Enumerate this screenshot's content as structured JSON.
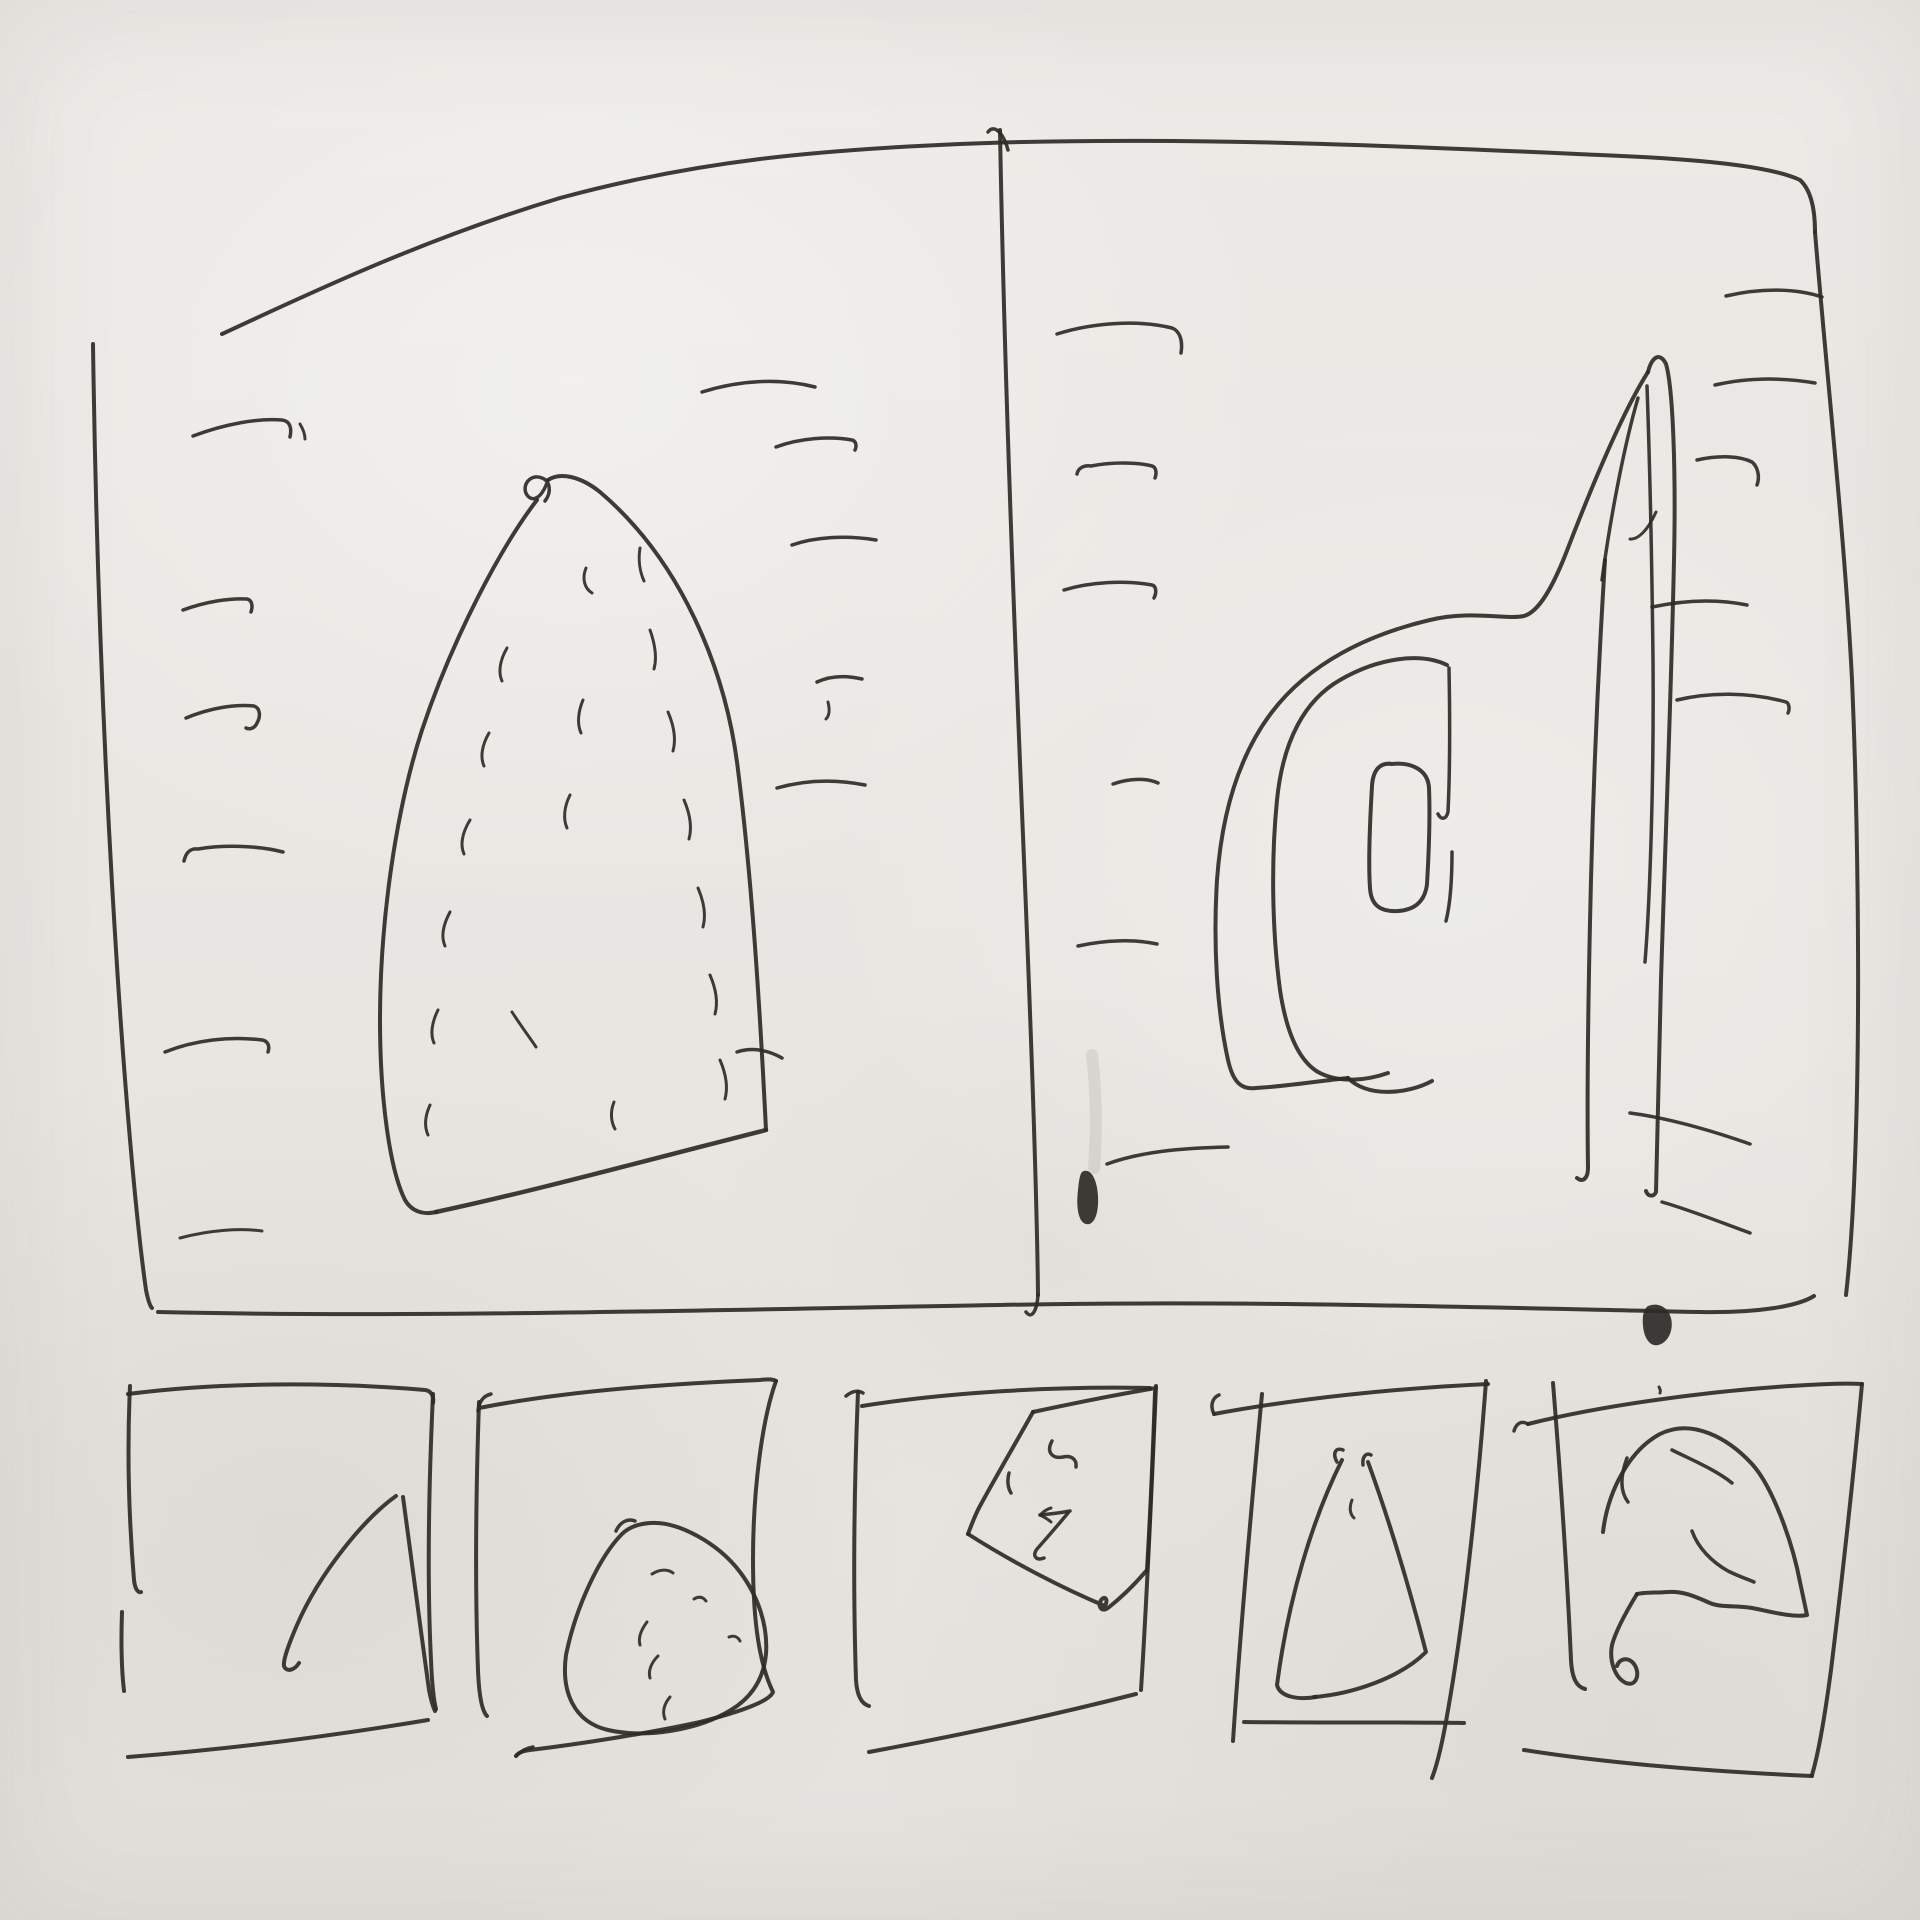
{
  "meta": {
    "title": "Hand-drawn ink wireframe sketch: two-panel viewer with filmstrip of five thumbnails",
    "canvas": {
      "width": 1920,
      "height": 1920
    }
  },
  "palette": {
    "paper": "#e9e7e2",
    "ink": "#2e2b27",
    "smudge": "#76726a"
  },
  "sketch": {
    "viewbox": "0 0 1920 1920",
    "default_width": 4,
    "strokes": [
      {
        "name": "main-frame-top-edge",
        "d": "M222,334 C300,298 420,240 560,198 C700,160 820,150 960,144 C1180,135 1420,147 1600,155 C1700,159 1770,166 1800,180 C1811,190 1815,210 1815,232",
        "w": 4
      },
      {
        "name": "main-frame-left-edge",
        "d": "M93,344 C96,560 104,760 116,950 C124,1080 136,1220 146,1290 C148,1300 150,1306 152,1308",
        "w": 4
      },
      {
        "name": "main-frame-bottom-edge",
        "d": "M158,1312 C420,1318 700,1310 1000,1305 C1250,1300 1500,1308 1700,1312 C1760,1313 1798,1306 1814,1296",
        "w": 4
      },
      {
        "name": "main-frame-right-edge",
        "d": "M1815,232 C1828,390 1845,540 1852,680 C1858,820 1860,1000 1856,1130 C1854,1200 1850,1260 1846,1295",
        "w": 4
      },
      {
        "name": "panel-divider-line",
        "d": "M1000,130 C1004,360 1014,620 1024,860 C1031,1030 1037,1200 1038,1295",
        "w": 4
      },
      {
        "name": "panel-divider-top-hook",
        "d": "M1008,150 C1003,132 994,124 988,132",
        "w": 3.5
      },
      {
        "name": "panel-divider-bottom-hook",
        "d": "M1038,1295 C1037,1310 1032,1320 1026,1312",
        "w": 3.5
      },
      {
        "name": "left-margin-tick-1",
        "d": "M193,436 C225,424 258,418 282,420 C290,421 292,428 290,437",
        "w": 3.5
      },
      {
        "name": "left-margin-tick-1-apostrophe",
        "d": "M300,424 C303,429 305,434 305,439",
        "w": 3
      },
      {
        "name": "left-margin-tick-2",
        "d": "M183,610 C205,602 228,598 247,599 C252,600 253,606 251,612",
        "w": 3.5
      },
      {
        "name": "left-margin-tick-3",
        "d": "M186,718 C210,708 235,704 254,706 C260,708 261,716 257,723 C255,728 250,730 246,728",
        "w": 3.5
      },
      {
        "name": "left-margin-tick-4",
        "d": "M184,861 C186,852 191,848 198,849 C222,845 256,845 283,852",
        "w": 3.5
      },
      {
        "name": "left-margin-tick-5",
        "d": "M165,1052 C195,1040 230,1036 262,1040 C268,1041 270,1046 268,1052",
        "w": 3.5
      },
      {
        "name": "left-margin-tick-6",
        "d": "M180,1238 C210,1230 240,1228 262,1231",
        "w": 3
      },
      {
        "name": "sail-shape-left-edge",
        "d": "M537,500 C500,548 452,640 422,730 C396,810 380,920 380,1020 C380,1100 390,1170 405,1200 C412,1212 424,1215 436,1212",
        "w": 4
      },
      {
        "name": "sail-shape-bottom-edge",
        "d": "M436,1212 C530,1192 640,1162 766,1130",
        "w": 4.5
      },
      {
        "name": "sail-shape-right-edge",
        "d": "M766,1130 C760,1010 752,880 738,770 C726,668 680,560 600,492 C580,476 560,472 548,480",
        "w": 4
      },
      {
        "name": "sail-apex-loop",
        "d": "M548,480 C542,498 533,503 527,495 C521,486 530,473 542,478 C550,481 552,492 545,501",
        "w": 3.5
      },
      {
        "name": "sail-hatch-1",
        "d": "M586,568 C582,578 584,588 592,593",
        "w": 3
      },
      {
        "name": "sail-hatch-2",
        "d": "M640,548 C638,560 640,572 644,581",
        "w": 3
      },
      {
        "name": "sail-hatch-3",
        "d": "M507,648 C500,660 498,672 502,681",
        "w": 3
      },
      {
        "name": "sail-hatch-4",
        "d": "M489,733 C482,745 480,757 484,766",
        "w": 3
      },
      {
        "name": "sail-hatch-5",
        "d": "M470,820 C462,833 460,845 464,854",
        "w": 3
      },
      {
        "name": "sail-hatch-6",
        "d": "M450,912 C443,925 441,937 445,946",
        "w": 3
      },
      {
        "name": "sail-hatch-7",
        "d": "M438,1010 C432,1022 430,1034 434,1043",
        "w": 3
      },
      {
        "name": "sail-hatch-8",
        "d": "M430,1105 C425,1116 424,1126 428,1135",
        "w": 3
      },
      {
        "name": "sail-hatch-9",
        "d": "M650,630 C655,644 657,658 654,669",
        "w": 3
      },
      {
        "name": "sail-hatch-10",
        "d": "M668,712 C674,726 676,740 673,751",
        "w": 3
      },
      {
        "name": "sail-hatch-11",
        "d": "M684,800 C690,814 692,828 689,839",
        "w": 3
      },
      {
        "name": "sail-hatch-12",
        "d": "M698,888 C704,902 706,916 703,927",
        "w": 3
      },
      {
        "name": "sail-hatch-13",
        "d": "M710,975 C716,989 718,1003 715,1014",
        "w": 3
      },
      {
        "name": "sail-hatch-14",
        "d": "M720,1060 C726,1074 728,1088 725,1099",
        "w": 3
      },
      {
        "name": "sail-hatch-15",
        "d": "M583,700 C578,712 577,724 581,733",
        "w": 3
      },
      {
        "name": "sail-hatch-16",
        "d": "M570,795 C564,807 563,819 567,828",
        "w": 3
      },
      {
        "name": "sail-hatch-17",
        "d": "M512,1012 C521,1026 530,1038 536,1047",
        "w": 3
      },
      {
        "name": "sail-hatch-18",
        "d": "M614,1102 C610,1112 611,1122 615,1129",
        "w": 3
      },
      {
        "name": "center-tick-1",
        "d": "M702,392 C740,380 780,378 815,387",
        "w": 3.5
      },
      {
        "name": "center-tick-2",
        "d": "M776,447 C800,438 830,436 852,440 C856,441 857,446 855,450",
        "w": 3.5
      },
      {
        "name": "center-tick-3",
        "d": "M792,545 C815,537 845,535 876,540",
        "w": 3.5
      },
      {
        "name": "center-tick-4",
        "d": "M817,682 C830,676 845,675 862,679",
        "w": 3.5
      },
      {
        "name": "center-tick-4-apostrophe",
        "d": "M828,702 C830,710 829,716 826,719",
        "w": 3
      },
      {
        "name": "center-tick-5",
        "d": "M777,788 C805,780 835,779 865,785",
        "w": 3.5
      },
      {
        "name": "center-tick-6",
        "d": "M737,1052 C752,1047 768,1050 782,1058",
        "w": 3.5
      },
      {
        "name": "right-panel-tick-1",
        "d": "M1057,334 C1095,322 1140,320 1172,328 C1180,331 1183,341 1181,353",
        "w": 3.5
      },
      {
        "name": "right-panel-tick-2",
        "d": "M1077,474 C1078,468 1084,465 1091,466 C1111,462 1136,462 1152,466 C1156,467 1157,473 1155,478",
        "w": 3.5
      },
      {
        "name": "right-panel-tick-3",
        "d": "M1064,590 C1090,582 1125,580 1152,585 C1156,586 1157,592 1154,598",
        "w": 3.5
      },
      {
        "name": "right-panel-tick-4",
        "d": "M1113,784 C1130,778 1148,778 1158,783",
        "w": 3.5
      },
      {
        "name": "right-panel-tick-5",
        "d": "M1078,946 C1105,940 1135,939 1157,944",
        "w": 3.5
      },
      {
        "name": "right-panel-tick-6",
        "d": "M1107,1164 C1140,1152 1180,1148 1228,1147",
        "w": 3.5
      },
      {
        "name": "right-edge-tick-1",
        "d": "M1726,296 C1760,288 1795,288 1822,297",
        "w": 3.5
      },
      {
        "name": "right-edge-tick-2",
        "d": "M1715,385 C1745,378 1780,377 1815,383",
        "w": 3.5
      },
      {
        "name": "right-edge-tick-3",
        "d": "M1697,460 C1720,455 1740,456 1752,462 C1758,467 1760,477 1757,485",
        "w": 3.5
      },
      {
        "name": "right-edge-tick-4",
        "d": "M1652,607 C1685,600 1718,599 1747,605",
        "w": 3.5
      },
      {
        "name": "right-edge-tick-5",
        "d": "M1677,700 C1710,692 1750,692 1786,702 C1789,703 1790,709 1788,713",
        "w": 3.5
      },
      {
        "name": "strip-cross-tick-upper",
        "d": "M1630,1113 C1668,1118 1710,1130 1750,1144",
        "w": 3.5
      },
      {
        "name": "strip-cross-tick-lower",
        "d": "M1662,1202 C1690,1210 1720,1222 1750,1233",
        "w": 3.5
      },
      {
        "name": "ear-shape-outer-curve",
        "d": "M1648,372 C1625,408 1595,478 1568,548 C1552,590 1538,612 1524,616 C1505,620 1470,610 1430,620 C1370,634 1310,662 1272,712 C1240,754 1222,810 1217,880 C1213,945 1217,1010 1228,1060 C1233,1082 1241,1090 1256,1088 C1291,1086 1326,1080 1348,1078",
        "w": 4
      },
      {
        "name": "ear-shape-outer-bottom-wave",
        "d": "M1348,1078 C1368,1098 1408,1094 1432,1081",
        "w": 4
      },
      {
        "name": "ear-shape-middle-curve",
        "d": "M1447,665 C1420,652 1378,658 1340,680 C1305,700 1283,740 1277,800 C1271,860 1272,930 1280,990 C1286,1030 1298,1060 1318,1072 C1340,1084 1368,1080 1388,1073",
        "w": 4
      },
      {
        "name": "ear-shape-inner-vertical",
        "d": "M1449,668 C1450,720 1450,770 1448,812 C1446,820 1441,820 1438,814",
        "w": 3.5
      },
      {
        "name": "ear-shape-inner-vertical-2",
        "d": "M1452,852 C1452,880 1450,905 1446,921",
        "w": 3.5
      },
      {
        "name": "ear-shape-inner-pillar",
        "d": "M1392,764 C1380,762 1373,770 1372,786 C1370,820 1368,860 1370,888 C1371,905 1380,912 1398,911 C1414,910 1425,902 1427,884 C1429,850 1430,812 1429,788 C1428,770 1412,762 1392,764",
        "w": 4
      },
      {
        "name": "steeple-right-edge",
        "d": "M1648,372 C1652,356 1660,352 1666,364 C1673,388 1676,470 1674,560 C1671,700 1665,850 1661,980 C1658,1080 1657,1150 1656,1192 C1654,1197 1648,1197 1646,1191",
        "w": 4
      },
      {
        "name": "steeple-strip-left-line",
        "d": "M1605,560 C1600,640 1594,760 1591,880 C1588,1000 1587,1100 1588,1168 C1588,1178 1583,1183 1577,1178",
        "w": 4
      },
      {
        "name": "steeple-inner-left-diagonal",
        "d": "M1638,398 C1624,446 1610,520 1602,580",
        "w": 3.5
      },
      {
        "name": "steeple-inner-right-line",
        "d": "M1647,386 C1650,470 1652,570 1653,660 C1654,780 1650,900 1645,962",
        "w": 3.5
      },
      {
        "name": "steeple-inner-hook",
        "d": "M1656,512 C1648,530 1638,540 1630,539",
        "w": 3
      },
      {
        "name": "ink-smudge-streak",
        "d": "M1092,1055 C1096,1090 1097,1130 1094,1168",
        "w": 12,
        "color": "smudge",
        "opacity": 0.14
      },
      {
        "name": "ink-blob-divider",
        "d": "M1082,1172 C1090,1167 1097,1178 1098,1196 C1099,1214 1094,1226 1086,1224 C1078,1222 1076,1206 1078,1190 C1079,1180 1080,1174 1082,1172 Z",
        "fill": "ink"
      },
      {
        "name": "ink-blob-bottom-edge",
        "d": "M1648,1306 C1658,1302 1668,1307 1671,1318 C1674,1330 1668,1343 1658,1345 C1650,1347 1644,1338 1643,1326 C1642,1315 1644,1309 1648,1306 Z",
        "fill": "ink"
      },
      {
        "name": "thumb1-left-edge",
        "d": "M130,1386 C127,1450 129,1520 134,1580 C135,1589 138,1593 141,1592",
        "w": 4
      },
      {
        "name": "thumb1-left-edge-lower",
        "d": "M122,1612 C121,1640 121,1665 124,1691",
        "w": 4
      },
      {
        "name": "thumb1-top-edge",
        "d": "M128,1394 C220,1382 330,1382 425,1390 C432,1391 434,1397 433,1403",
        "w": 4
      },
      {
        "name": "thumb1-right-edge",
        "d": "M433,1394 C429,1480 427,1580 431,1660 C432,1686 434,1701 436,1709",
        "w": 4
      },
      {
        "name": "thumb1-bottom-edge",
        "d": "M128,1757 C220,1750 320,1738 428,1720",
        "w": 4
      },
      {
        "name": "thumb1-sail-left",
        "d": "M396,1496 C365,1518 320,1572 297,1625 C288,1646 283,1660 284,1666 C286,1672 294,1671 299,1663",
        "w": 4
      },
      {
        "name": "thumb1-sail-right",
        "d": "M403,1497 C411,1556 420,1625 429,1690 C431,1700 433,1707 435,1711",
        "w": 4
      },
      {
        "name": "thumb2-left-edge",
        "d": "M479,1402 C476,1490 475,1590 478,1670 C479,1696 482,1711 487,1716",
        "w": 4
      },
      {
        "name": "thumb2-left-top-hook",
        "d": "M491,1394 C483,1396 479,1402 478,1411",
        "w": 3.5
      },
      {
        "name": "thumb2-top-edge",
        "d": "M479,1408 C560,1392 660,1384 760,1380 C768,1379 773,1379 776,1381",
        "w": 4
      },
      {
        "name": "thumb2-right-and-bottom",
        "d": "M776,1381 C762,1420 753,1490 753,1560 C753,1625 760,1665 773,1692 C770,1701 740,1712 700,1722 C650,1733 580,1744 530,1750 C522,1751 518,1753 516,1756",
        "w": 4
      },
      {
        "name": "thumb2-bottom-arrow-barb",
        "d": "M516,1756 C521,1751 527,1748 533,1747",
        "w": 3.5
      },
      {
        "name": "thumb2-pillow-outline",
        "d": "M622,1534 C600,1556 576,1606 566,1655 C561,1692 574,1722 608,1730 C648,1739 700,1729 731,1710 C754,1696 764,1676 766,1654 C768,1625 758,1596 740,1572 C718,1543 678,1521 650,1523 C637,1524 628,1528 622,1534",
        "w": 4
      },
      {
        "name": "thumb2-pillow-apex-hook",
        "d": "M616,1531 C620,1522 628,1518 635,1521",
        "w": 3.5
      },
      {
        "name": "thumb2-pillow-hatch-1",
        "d": "M652,1574 C660,1569 668,1569 673,1573",
        "w": 3
      },
      {
        "name": "thumb2-pillow-hatch-2",
        "d": "M694,1599 C699,1596 703,1597 706,1601",
        "w": 3
      },
      {
        "name": "thumb2-pillow-hatch-3",
        "d": "M647,1622 C641,1630 638,1638 640,1645",
        "w": 3
      },
      {
        "name": "thumb2-pillow-hatch-4",
        "d": "M729,1637 C734,1635 738,1637 740,1641",
        "w": 3
      },
      {
        "name": "thumb2-pillow-hatch-5",
        "d": "M658,1656 C651,1663 648,1671 650,1678",
        "w": 3
      },
      {
        "name": "thumb2-pillow-hatch-6",
        "d": "M670,1697 C664,1704 662,1712 665,1719",
        "w": 3
      },
      {
        "name": "thumb3-left-edge",
        "d": "M858,1392 C854,1490 853,1590 856,1680 C857,1696 862,1704 869,1706",
        "w": 4
      },
      {
        "name": "thumb3-left-top-hook",
        "d": "M846,1396 C852,1391 858,1390 863,1393",
        "w": 3.5
      },
      {
        "name": "thumb3-top-edge",
        "d": "M862,1406 C950,1392 1060,1386 1150,1388",
        "w": 4
      },
      {
        "name": "thumb3-right-edge",
        "d": "M1156,1386 C1152,1480 1148,1580 1141,1690",
        "w": 4
      },
      {
        "name": "thumb3-bottom-edge",
        "d": "M869,1752 C950,1737 1050,1716 1136,1694",
        "w": 4
      },
      {
        "name": "thumb3-diamond-top-edge",
        "d": "M1033,1412 C1075,1403 1120,1394 1156,1388",
        "w": 4
      },
      {
        "name": "thumb3-diamond-left-edge",
        "d": "M1033,1412 C1014,1446 994,1480 980,1506 C975,1515 971,1526 968,1534",
        "w": 4
      },
      {
        "name": "thumb3-diamond-bottom-edge",
        "d": "M968,1534 C1012,1562 1062,1588 1105,1606 C1109,1599 1104,1594 1100,1602 C1098,1608 1103,1612 1108,1608 C1122,1597 1136,1583 1147,1570",
        "w": 4
      },
      {
        "name": "thumb3-diamond-right-edge",
        "d": "M1147,1570 C1150,1520 1153,1450 1155,1392",
        "w": 4
      },
      {
        "name": "thumb3-mark-s-hook",
        "d": "M1052,1441 C1046,1452 1052,1459 1063,1457 C1072,1455 1077,1460 1076,1467",
        "w": 3.5
      },
      {
        "name": "thumb3-mark-dash",
        "d": "M1009,1473 C1007,1481 1008,1488 1011,1493",
        "w": 3.5
      },
      {
        "name": "thumb3-mark-arrow-shaft",
        "d": "M1070,1511 C1060,1513 1050,1514 1040,1515",
        "w": 3.5
      },
      {
        "name": "thumb3-mark-arrow-barb-upper",
        "d": "M1040,1515 C1043,1512 1047,1509 1051,1508",
        "w": 3
      },
      {
        "name": "thumb3-mark-arrow-barb-lower",
        "d": "M1040,1515 C1044,1517 1048,1519 1051,1522",
        "w": 3
      },
      {
        "name": "thumb3-mark-arrow-diagonal",
        "d": "M1068,1513 C1058,1525 1045,1540 1037,1549 C1032,1556 1036,1561 1044,1558",
        "w": 3.5
      },
      {
        "name": "thumb4-top-edge",
        "d": "M1214,1414 C1300,1398 1400,1388 1488,1384",
        "w": 4
      },
      {
        "name": "thumb4-top-left-hook",
        "d": "M1214,1414 C1210,1406 1212,1398 1219,1395",
        "w": 3.5
      },
      {
        "name": "thumb4-left-edge",
        "d": "M1262,1394 C1252,1500 1241,1620 1233,1741",
        "w": 4
      },
      {
        "name": "thumb4-right-edge",
        "d": "M1486,1381 C1478,1490 1464,1620 1448,1710 C1443,1740 1437,1765 1432,1778",
        "w": 4
      },
      {
        "name": "thumb4-bottom-edge",
        "d": "M1244,1722 C1320,1723 1400,1722 1464,1723",
        "w": 4
      },
      {
        "name": "thumb4-triangle-left",
        "d": "M1342,1460 C1312,1520 1288,1600 1277,1685 C1280,1697 1298,1700 1316,1697",
        "w": 4
      },
      {
        "name": "thumb4-triangle-right",
        "d": "M1368,1462 C1392,1528 1412,1598 1426,1652 C1400,1678 1352,1694 1314,1697",
        "w": 4
      },
      {
        "name": "thumb4-triangle-apex-1",
        "d": "M1337,1462 C1332,1453 1336,1447 1343,1450",
        "w": 3.5
      },
      {
        "name": "thumb4-triangle-apex-2",
        "d": "M1363,1465 C1362,1457 1366,1452 1371,1455",
        "w": 3.5
      },
      {
        "name": "thumb4-triangle-tick",
        "d": "M1352,1500 C1349,1508 1350,1514 1354,1518",
        "w": 3
      },
      {
        "name": "thumb5-top-edge",
        "d": "M1528,1424 C1600,1406 1700,1392 1790,1386 C1820,1384 1848,1383 1862,1384",
        "w": 4
      },
      {
        "name": "thumb5-top-left-hook",
        "d": "M1528,1424 C1521,1420 1516,1424 1514,1431",
        "w": 3.5
      },
      {
        "name": "thumb5-left-edge",
        "d": "M1553,1383 C1560,1470 1567,1570 1571,1660 C1572,1679 1577,1687 1585,1689",
        "w": 4
      },
      {
        "name": "thumb5-right-edge",
        "d": "M1862,1384 C1854,1470 1842,1580 1831,1670 C1825,1715 1818,1755 1812,1775",
        "w": 4
      },
      {
        "name": "thumb5-bottom-edge",
        "d": "M1524,1750 C1600,1762 1700,1771 1812,1776",
        "w": 4
      },
      {
        "name": "thumb5-arch-outline",
        "d": "M1603,1532 C1608,1490 1630,1450 1660,1434 C1692,1418 1728,1438 1752,1464 C1772,1486 1792,1540 1800,1582 C1803,1596 1806,1610 1807,1615 C1793,1618 1768,1611 1752,1608 C1736,1605 1722,1608 1710,1603 C1696,1597 1684,1591 1668,1592 C1655,1593 1644,1592 1637,1594",
        "w": 4
      },
      {
        "name": "thumb5-arch-left-start",
        "d": "M1627,1458 C1621,1474 1619,1490 1628,1502",
        "w": 3.5
      },
      {
        "name": "thumb5-arch-leg-loop",
        "d": "M1637,1594 C1626,1612 1616,1630 1612,1645 C1609,1661 1615,1678 1626,1683 C1636,1687 1641,1674 1634,1664 C1628,1656 1619,1659 1617,1666",
        "w": 4
      },
      {
        "name": "thumb5-arch-inner-top-curve",
        "d": "M1672,1450 C1692,1460 1716,1470 1732,1483",
        "w": 3.5
      },
      {
        "name": "thumb5-arch-inner-s-curve",
        "d": "M1692,1531 C1698,1548 1712,1562 1728,1571 C1740,1577 1750,1580 1754,1582",
        "w": 3.5
      },
      {
        "name": "thumb5-paper-speck",
        "d": "M1659,1387 C1660,1389 1661,1391 1660,1393",
        "w": 3
      }
    ]
  }
}
